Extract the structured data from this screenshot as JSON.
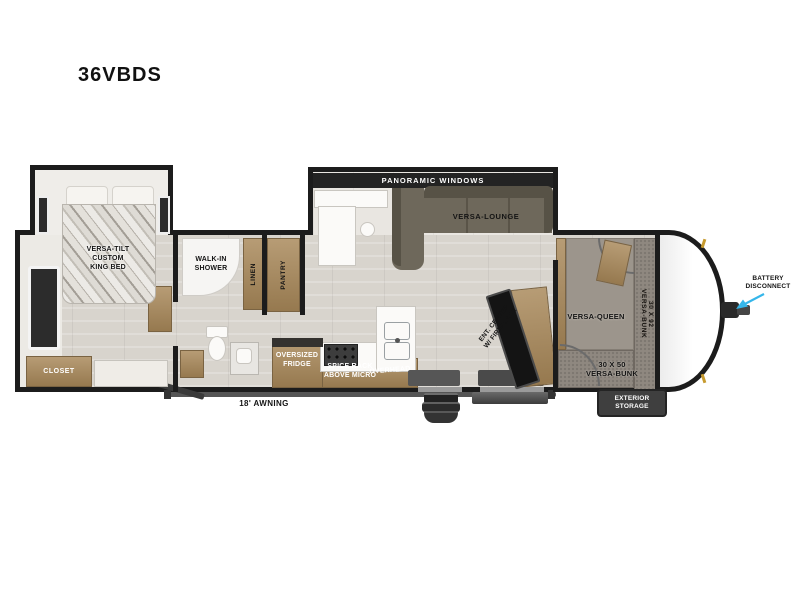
{
  "title": "36VBDS",
  "colors": {
    "wall": "#1c1c1c",
    "floor": "#d8d4cd",
    "wood": "#a88c63",
    "sofa": "#6e685b",
    "bunk_gray": "#8f8880",
    "arrow_cyan": "#35b6ea",
    "badge_dark": "#3f3f3f"
  },
  "labels": {
    "panoramic_windows": "PANORAMIC WINDOWS",
    "versa_lounge": "VERSA-LOUNGE",
    "king_bed_lines": [
      "VERSA-TILT",
      "CUSTOM",
      "KING BED"
    ],
    "closet": "CLOSET",
    "walk_in_shower_lines": [
      "WALK-IN",
      "SHOWER"
    ],
    "linen": "LINEN",
    "pantry": "PANTRY",
    "oversized_fridge_lines": [
      "OVERSIZED",
      "FRIDGE"
    ],
    "spice_rack_lines": [
      "SPICE RACK",
      "ABOVE MICRO"
    ],
    "overhead": "OVERHEAD",
    "ent_center_lines": [
      "ENT. CENTER",
      "W/ FIREPLACE"
    ],
    "versa_queen": "VERSA-QUEEN",
    "bunk_30x92_lines": [
      "30 X 92",
      "VERSA-BUNK"
    ],
    "bunk_30x50_lines": [
      "30 X 50",
      "VERSA-BUNK"
    ],
    "awning": "18' AWNING",
    "exterior_storage_lines": [
      "EXTERIOR",
      "STORAGE"
    ],
    "battery_disconnect_lines": [
      "BATTERY",
      "DISCONNECT"
    ]
  }
}
